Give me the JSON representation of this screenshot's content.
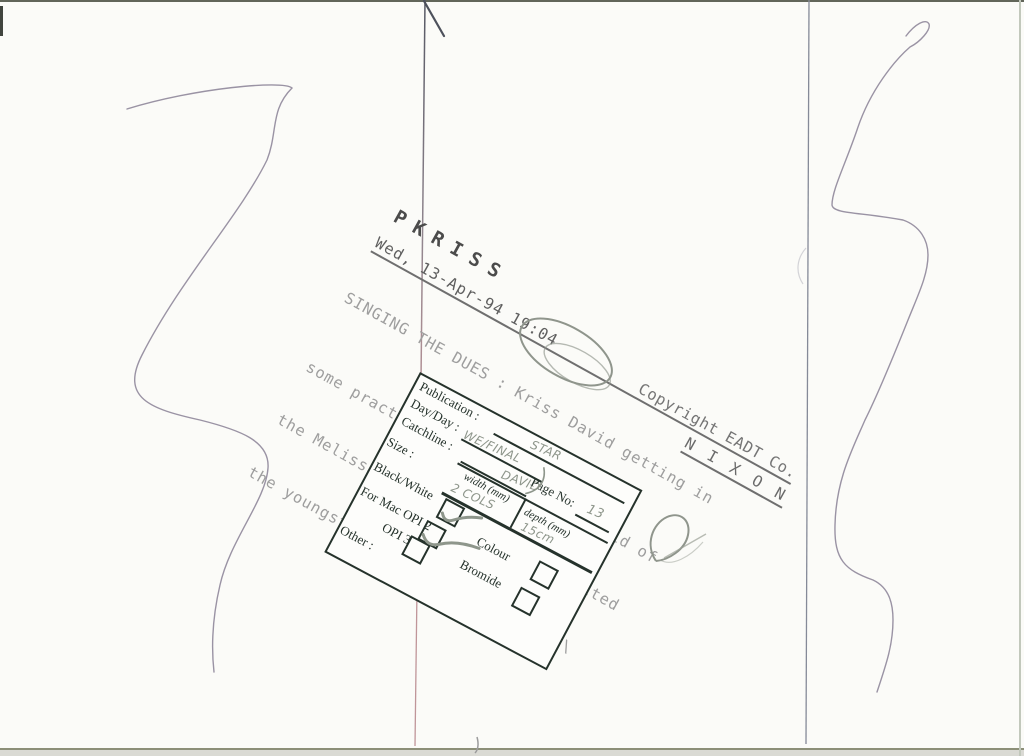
{
  "document_type": "press-photo-verso-scan",
  "typed_block": {
    "slug": "PKRISS",
    "dateline": "Wed, 13-Apr-94 19:04",
    "copyright": "Copyright EADT Co.",
    "photographer": "N I X O N",
    "caption_lines": [
      "SINGING THE DUES : Kriss David getting in",
      "some practice for his concert in aid of",
      "the Melissa Cox Appeal when he visited",
      "the youngster in hospital yesterday\\"
    ]
  },
  "stamp_form": {
    "labels": {
      "publication": "Publication :",
      "day": "Day/Day :",
      "catchline": "Catchline :",
      "page_no": "Page No:",
      "size": "Size :",
      "width_header": "width (mm)",
      "depth_header": "depth (mm)",
      "black_white": "Black/White",
      "for_mac_opi2": "For Mac OPI 2",
      "opi3": "OPI 3",
      "other": "Other :",
      "colour": "Colour",
      "bromide": "Bromide"
    },
    "handwritten": {
      "publication": "STAR",
      "day": "WE/FINAL",
      "catchline": "DAVID",
      "page_no": "13",
      "width": "2 COLS",
      "depth": "15cm"
    },
    "checked": {
      "black_white": true,
      "for_mac_opi2": true,
      "opi3": false,
      "colour": false,
      "bromide": false
    }
  },
  "annotations": {
    "circled_word": "Kriss",
    "pen_marks": [
      "left-squiggle",
      "right-squiggle",
      "pencil-doodle",
      "kriss-circle"
    ]
  },
  "colors": {
    "paper": "#fbfbf8",
    "stamp-ink": "#25322b",
    "pencil": "#8e968b",
    "pen": "#9a93a4",
    "type-dark": "#5f5f5f",
    "type-mid": "#757575",
    "type-light": "#9e9e9e",
    "rule": "#6f6f6f"
  }
}
